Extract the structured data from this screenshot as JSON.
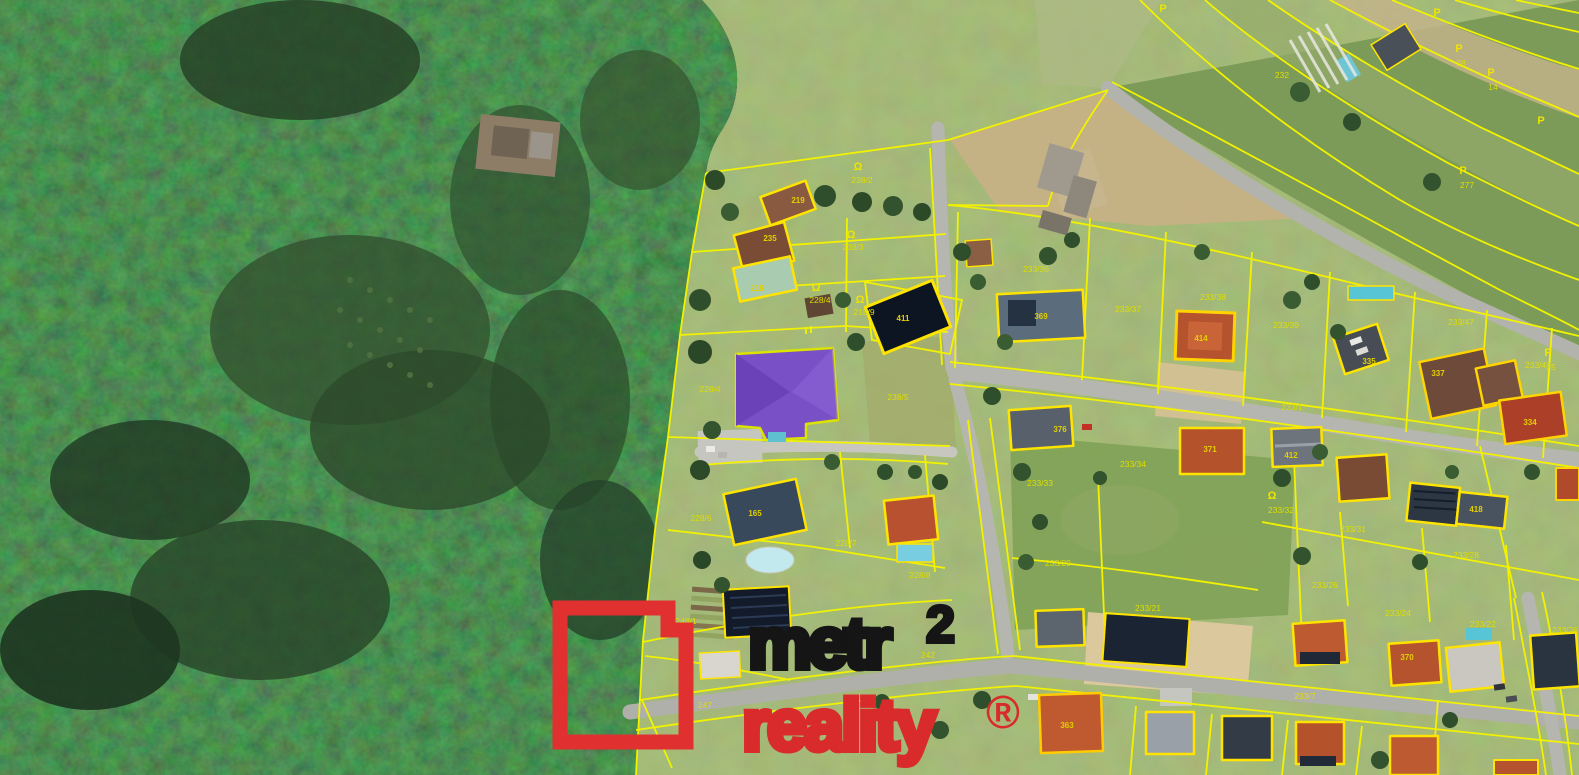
{
  "watermark": {
    "brand_top": "metr",
    "brand_sup": "2",
    "brand_bottom": "reality",
    "registered": "®",
    "square_color": "#e03030",
    "black": "#151515",
    "red": "#d92b2b"
  },
  "map": {
    "type": "aerial-cadastral",
    "line_color": "#f2f200",
    "label_color": "#dede00",
    "parcel_labels": [
      {
        "text": "238/2",
        "x": 862,
        "y": 183
      },
      {
        "text": "238/3",
        "x": 853,
        "y": 250
      },
      {
        "text": "228/4",
        "x": 820,
        "y": 303
      },
      {
        "text": "218/9",
        "x": 864,
        "y": 315
      },
      {
        "text": "228/4",
        "x": 710,
        "y": 392
      },
      {
        "text": "238/5",
        "x": 898,
        "y": 400
      },
      {
        "text": "228/6",
        "x": 701,
        "y": 521
      },
      {
        "text": "228/7",
        "x": 846,
        "y": 546
      },
      {
        "text": "228/8",
        "x": 920,
        "y": 578
      },
      {
        "text": "248/1",
        "x": 686,
        "y": 624
      },
      {
        "text": "242",
        "x": 928,
        "y": 658
      },
      {
        "text": "247",
        "x": 705,
        "y": 708
      },
      {
        "text": "233/36",
        "x": 1036,
        "y": 272
      },
      {
        "text": "233/37",
        "x": 1128,
        "y": 312
      },
      {
        "text": "233/38",
        "x": 1213,
        "y": 300
      },
      {
        "text": "233/39",
        "x": 1286,
        "y": 328
      },
      {
        "text": "233/47",
        "x": 1461,
        "y": 325
      },
      {
        "text": "233/43",
        "x": 1538,
        "y": 368
      },
      {
        "text": "233/1",
        "x": 1292,
        "y": 410
      },
      {
        "text": "233/33",
        "x": 1040,
        "y": 486
      },
      {
        "text": "233/29",
        "x": 1058,
        "y": 566
      },
      {
        "text": "233/34",
        "x": 1133,
        "y": 467
      },
      {
        "text": "233/21",
        "x": 1148,
        "y": 611
      },
      {
        "text": "233/32",
        "x": 1281,
        "y": 513
      },
      {
        "text": "233/31",
        "x": 1353,
        "y": 532
      },
      {
        "text": "233/28",
        "x": 1466,
        "y": 558
      },
      {
        "text": "233/26",
        "x": 1325,
        "y": 588
      },
      {
        "text": "233/24",
        "x": 1398,
        "y": 616
      },
      {
        "text": "233/22",
        "x": 1483,
        "y": 627
      },
      {
        "text": "233/26",
        "x": 1565,
        "y": 633
      },
      {
        "text": "233/7",
        "x": 1305,
        "y": 699
      },
      {
        "text": "232",
        "x": 1282,
        "y": 78
      },
      {
        "text": "28",
        "x": 1461,
        "y": 66
      },
      {
        "text": "14",
        "x": 1493,
        "y": 90
      },
      {
        "text": "277",
        "x": 1467,
        "y": 188
      },
      {
        "text": "25",
        "x": 1551,
        "y": 370
      }
    ],
    "building_labels": [
      {
        "text": "219",
        "x": 798,
        "y": 203
      },
      {
        "text": "235",
        "x": 770,
        "y": 241
      },
      {
        "text": "218",
        "x": 757,
        "y": 291
      },
      {
        "text": "411",
        "x": 903,
        "y": 321
      },
      {
        "text": "369",
        "x": 1041,
        "y": 319
      },
      {
        "text": "414",
        "x": 1201,
        "y": 341
      },
      {
        "text": "371",
        "x": 1210,
        "y": 452
      },
      {
        "text": "376",
        "x": 1060,
        "y": 432
      },
      {
        "text": "412",
        "x": 1291,
        "y": 458
      },
      {
        "text": "418",
        "x": 1476,
        "y": 512
      },
      {
        "text": "335",
        "x": 1369,
        "y": 364
      },
      {
        "text": "337",
        "x": 1438,
        "y": 376
      },
      {
        "text": "334",
        "x": 1530,
        "y": 425
      },
      {
        "text": "165",
        "x": 755,
        "y": 516
      },
      {
        "text": "363",
        "x": 1067,
        "y": 728
      },
      {
        "text": "370",
        "x": 1407,
        "y": 660
      }
    ],
    "symbols": [
      {
        "glyph": "Ω",
        "x": 858,
        "y": 170
      },
      {
        "glyph": "Ω",
        "x": 851,
        "y": 238
      },
      {
        "glyph": "Ω",
        "x": 816,
        "y": 291
      },
      {
        "glyph": "Ω",
        "x": 860,
        "y": 303
      },
      {
        "glyph": "Ω",
        "x": 1272,
        "y": 499
      },
      {
        "glyph": "P",
        "x": 1163,
        "y": 12
      },
      {
        "glyph": "P",
        "x": 1437,
        "y": 16
      },
      {
        "glyph": "P",
        "x": 1459,
        "y": 52
      },
      {
        "glyph": "P",
        "x": 1491,
        "y": 76
      },
      {
        "glyph": "P",
        "x": 1541,
        "y": 124
      },
      {
        "glyph": "P",
        "x": 1463,
        "y": 174
      },
      {
        "glyph": "P",
        "x": 1548,
        "y": 356
      }
    ]
  }
}
